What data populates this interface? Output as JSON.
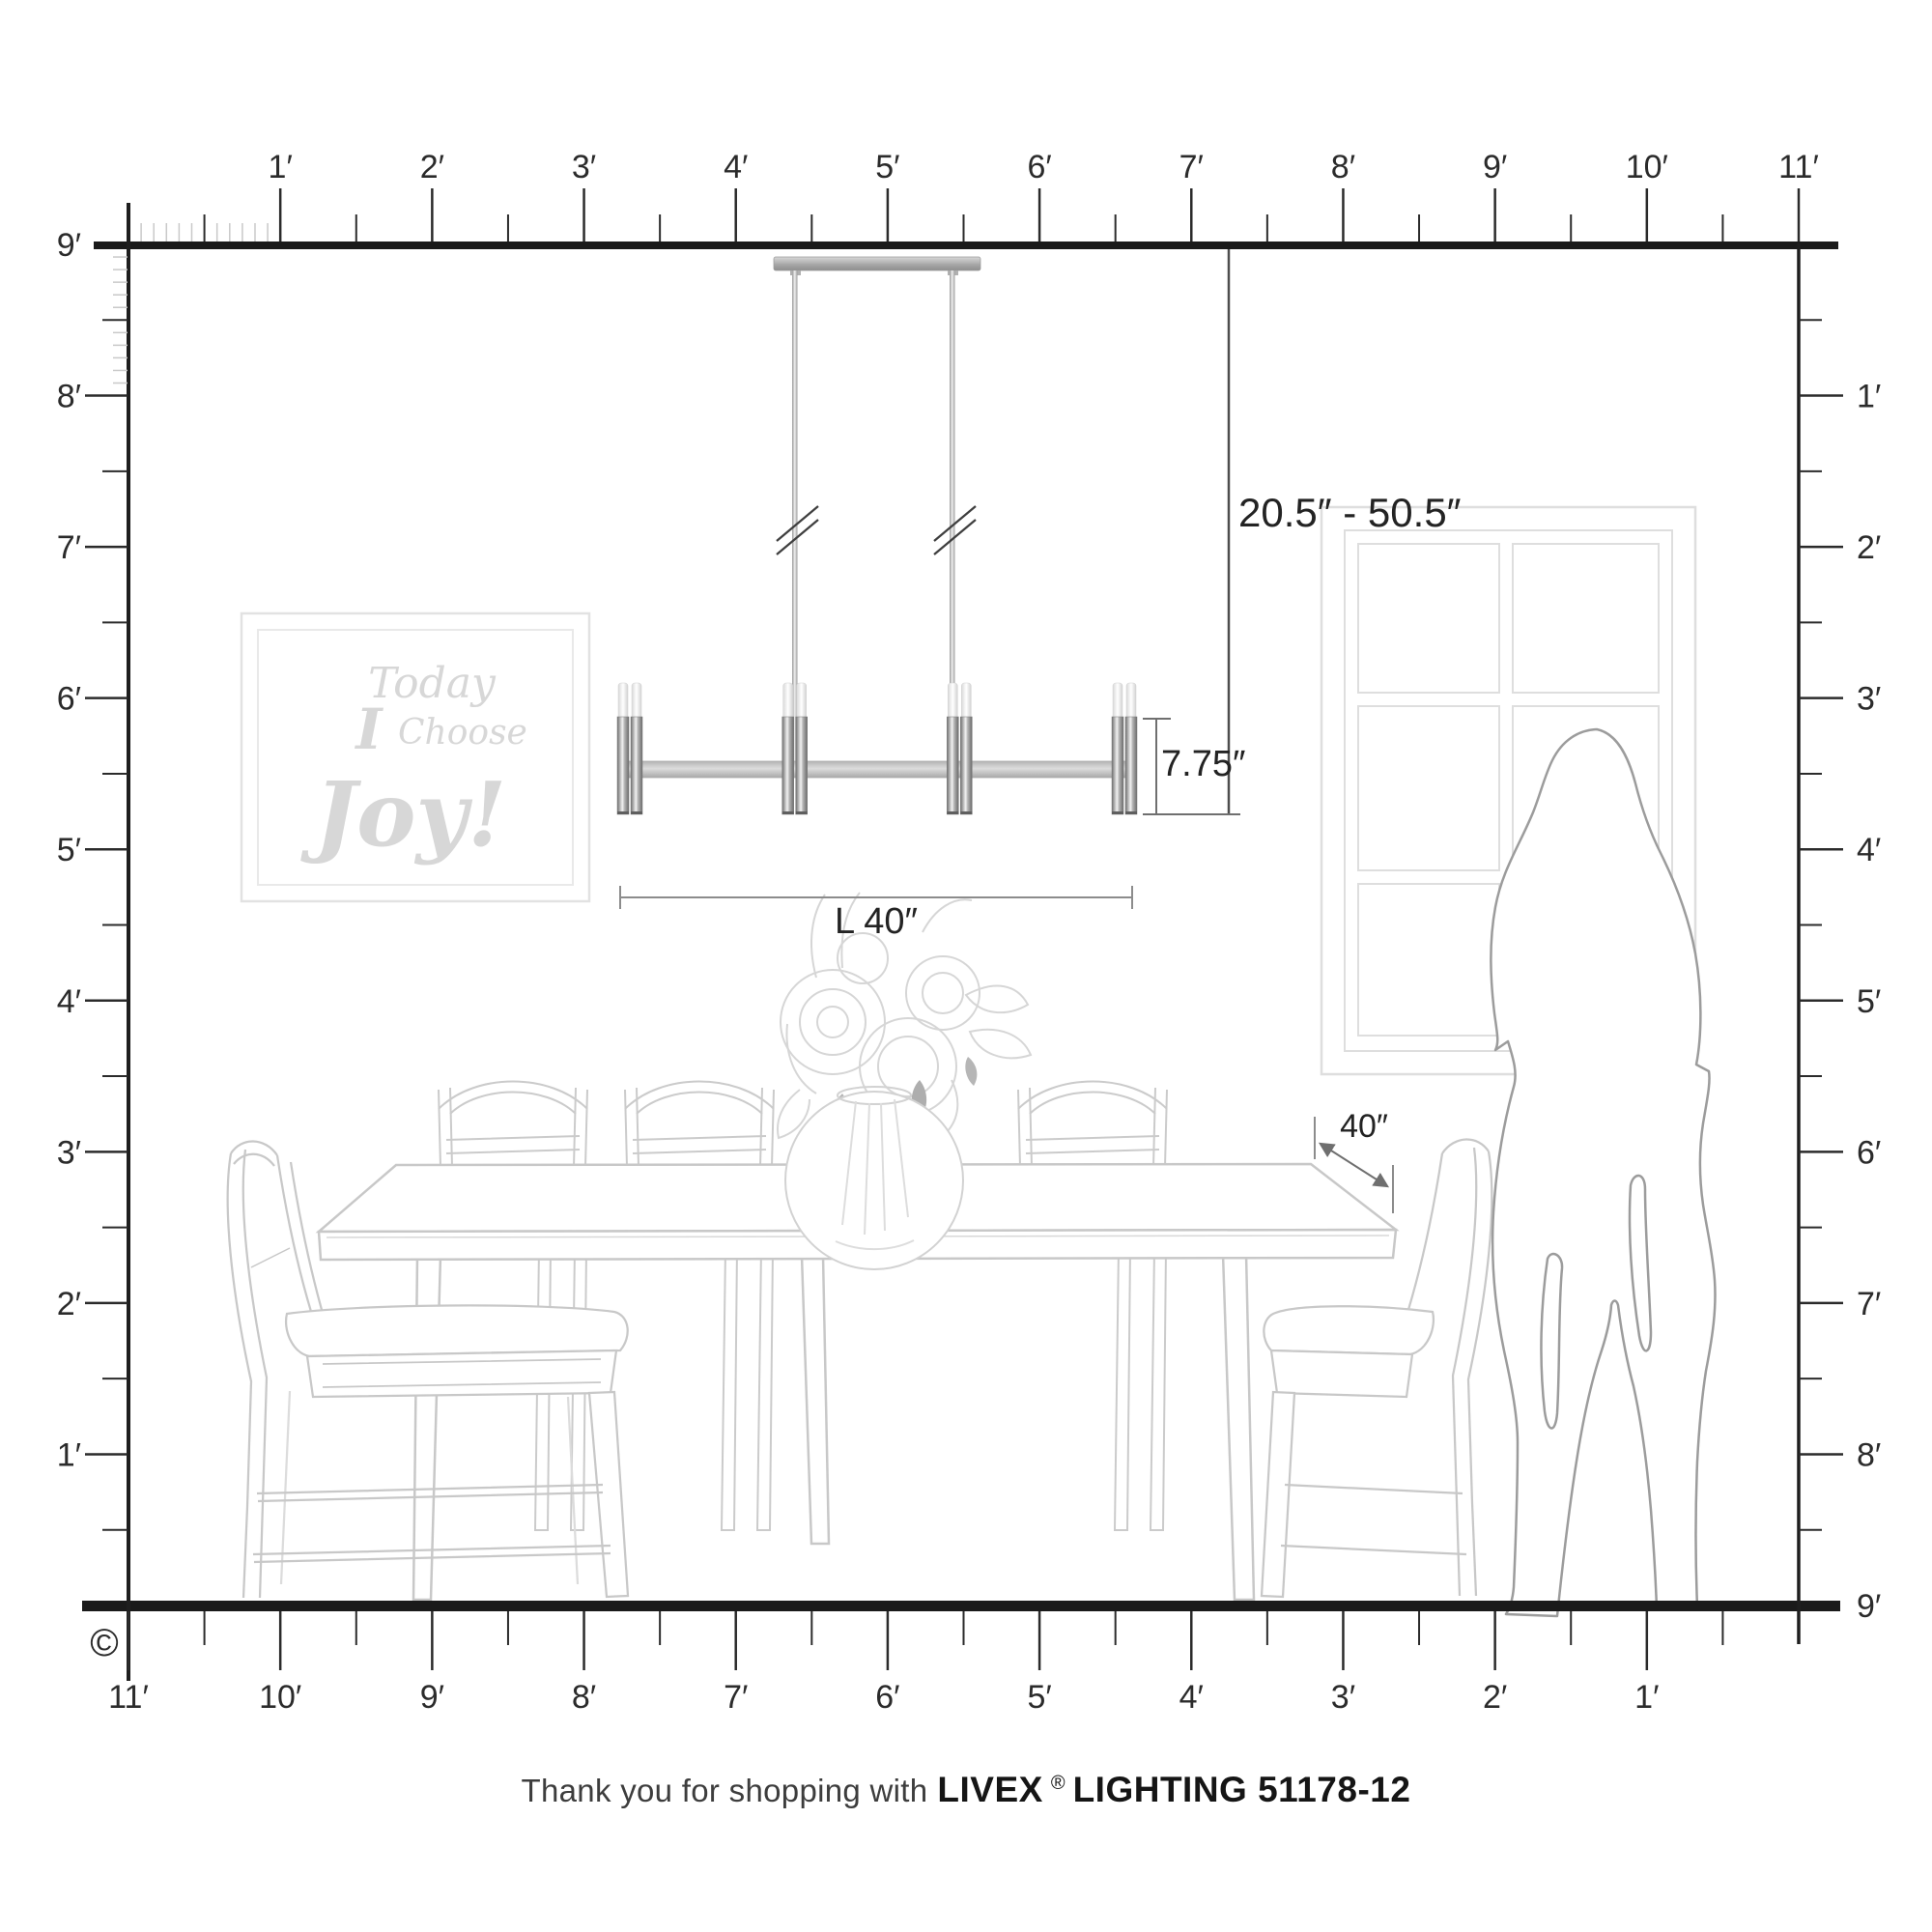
{
  "rulers": {
    "unit": "feet",
    "top": {
      "labels": [
        "1′",
        "2′",
        "3′",
        "4′",
        "5′",
        "6′",
        "7′",
        "8′",
        "9′",
        "10′",
        "11′"
      ]
    },
    "left": {
      "labels": [
        "9′",
        "8′",
        "7′",
        "6′",
        "5′",
        "4′",
        "3′",
        "2′",
        "1′"
      ]
    },
    "right": {
      "labels": [
        "1′",
        "2′",
        "3′",
        "4′",
        "5′",
        "6′",
        "7′",
        "8′",
        "9′"
      ]
    },
    "bottom": {
      "labels": [
        "11′",
        "10′",
        "9′",
        "8′",
        "7′",
        "6′",
        "5′",
        "4′",
        "3′",
        "2′",
        "1′"
      ]
    }
  },
  "dimensions": {
    "hanging_range": "20.5″ - 50.5″",
    "fixture_height": "7.75″",
    "fixture_length": "L 40″",
    "table_depth": "40″"
  },
  "wall_art": {
    "line1": "Today",
    "line2_lead": "I",
    "line2_rest": "Choose",
    "line3": "Joy!"
  },
  "footer": {
    "prefix": "Thank you for shopping with",
    "brand": "LIVEX",
    "registered": "®",
    "suffix": "LIGHTING 51178-12"
  },
  "copyright": "©",
  "colors": {
    "ruler": "#1c1c1c",
    "tick_major": "#2b2b2b",
    "tick_minor": "#c9c9c9",
    "dimension_line": "#6f6f6f",
    "dimension_text": "#232323",
    "furniture_line": "#c8c8c8",
    "window_line": "#dedede",
    "silhouette_line": "#9c9c9c",
    "art_text": "#d7d7d7",
    "metal_dark": "#6f6f6f",
    "metal_light": "#f0f0f0",
    "frosted_glass": "#e9e9e9"
  }
}
